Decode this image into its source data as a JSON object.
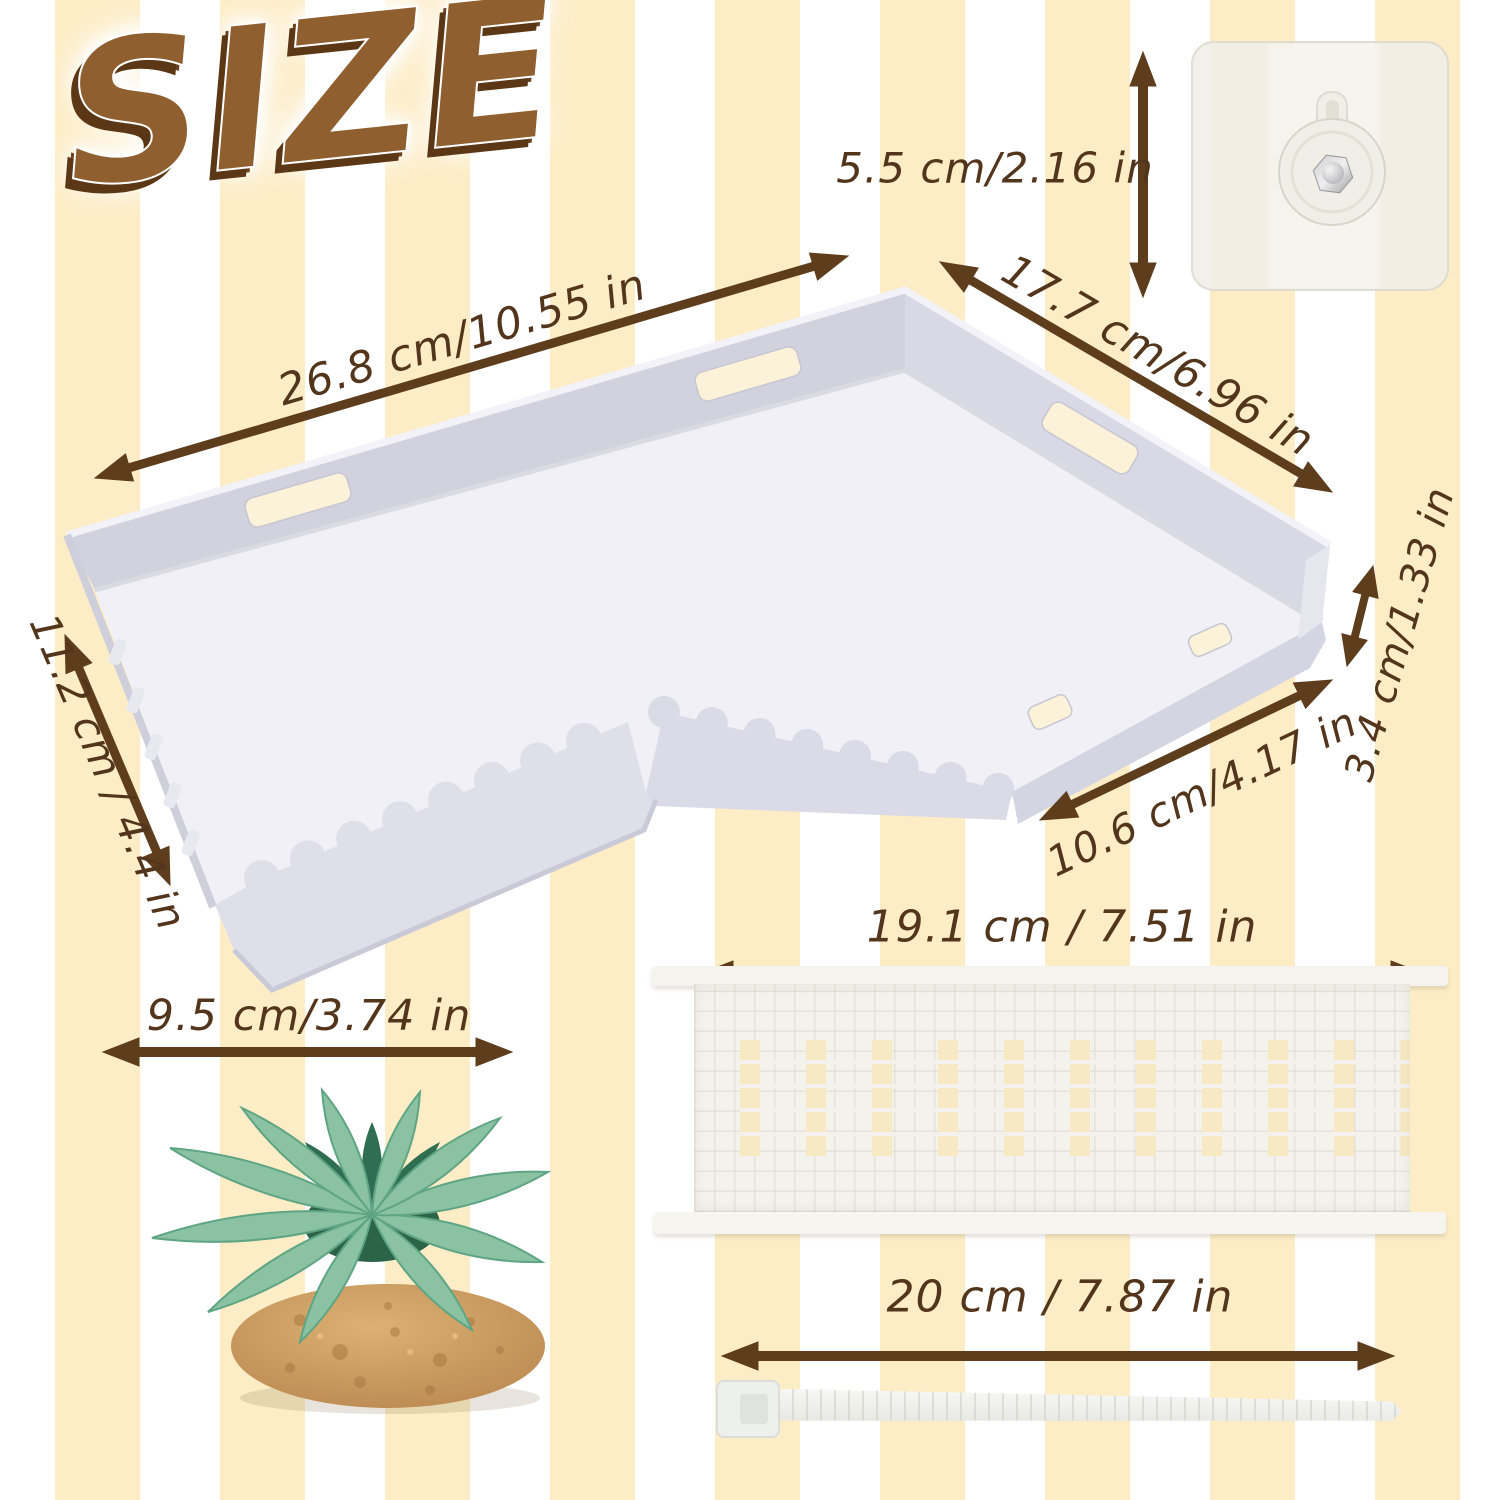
{
  "title": "SIZE",
  "dimensions": {
    "hook_height": "5.5 cm/2.16 in",
    "shelf_length": "26.8 cm/10.55 in",
    "shelf_side": "17.7 cm/6.96 in",
    "shelf_depth": "11.2 cm / 4.4 in",
    "rim_height": "3.4 cm/1.33 in",
    "shelf_front": "10.6 cm/4.17 in",
    "platform_length": "19.1 cm / 7.51 in",
    "plant_width": "9.5 cm/3.74 in",
    "tie_length": "20 cm / 7.87 in"
  },
  "colors": {
    "stripe_cream": "#fdedc6",
    "stripe_white": "#ffffff",
    "annotation_brown": "#5e3d1d",
    "text_brown": "#53351b",
    "title_fill": "#8f5f30",
    "title_shadow": "#5c3715",
    "shelf_plastic": "#d5d5e2",
    "shelf_floor": "#f0f0f6",
    "platform_white": "#f3f2ec",
    "plant_green_light": "#8ac2a2",
    "plant_green_dark": "#2f6e50",
    "mound_brown": "#b5834a"
  }
}
